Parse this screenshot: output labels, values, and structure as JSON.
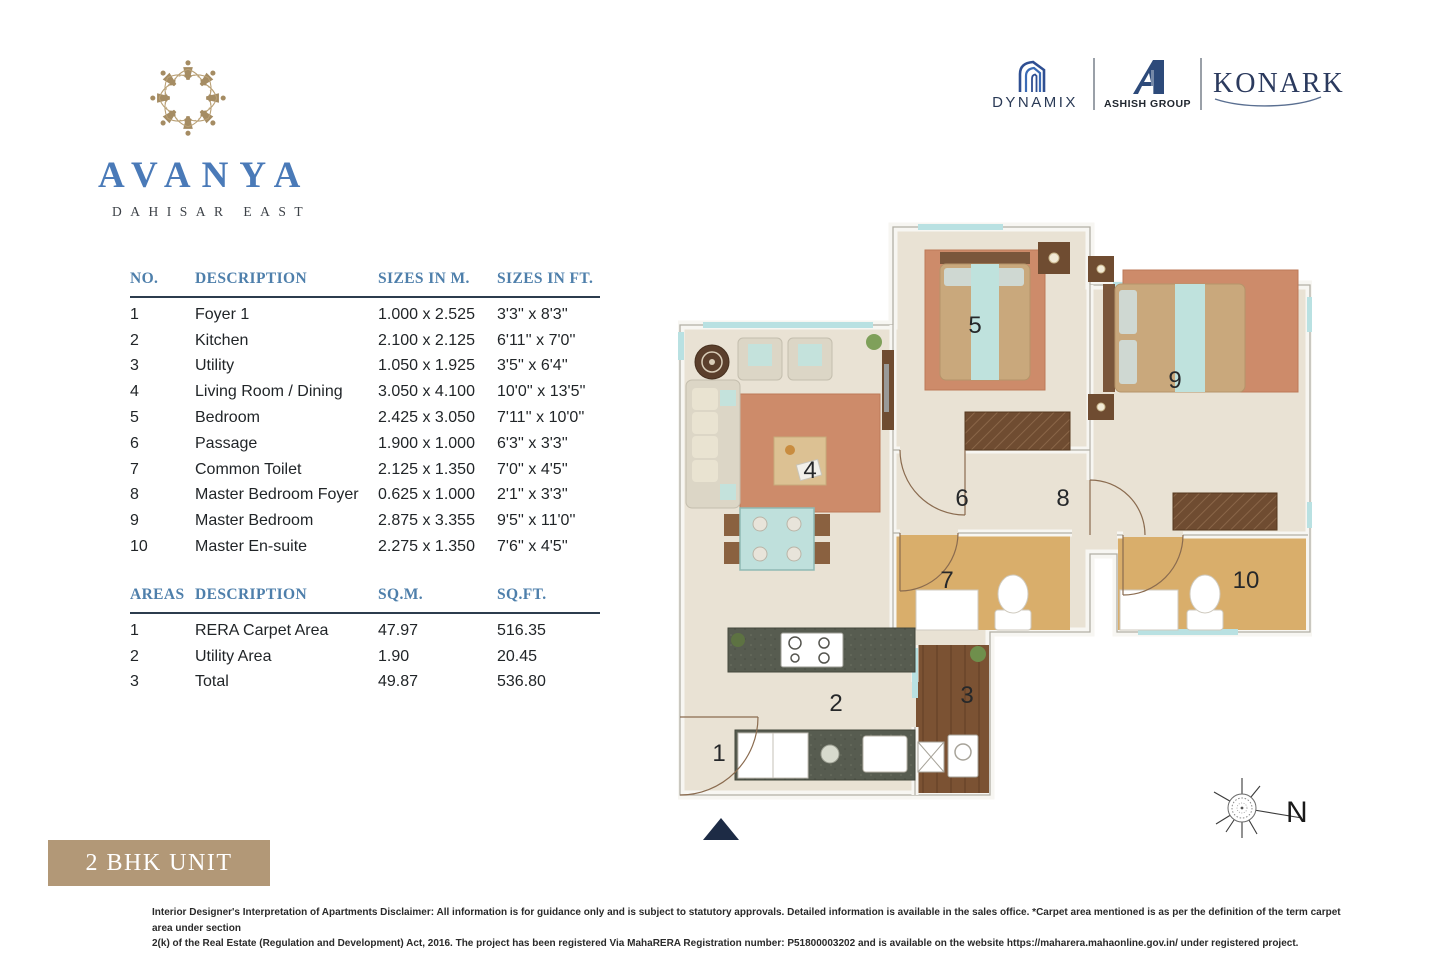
{
  "brand": {
    "name": "AVANYA",
    "location": "DAHISAR EAST"
  },
  "partners": {
    "dynamix": "DYNAMIX",
    "ashish": "ASHISH GROUP",
    "konark": "KONARK"
  },
  "dimensions_table": {
    "headers": [
      "NO.",
      "DESCRIPTION",
      "SIZES IN M.",
      "SIZES IN FT."
    ],
    "rows": [
      [
        "1",
        "Foyer 1",
        "1.000 x 2.525",
        "3'3'' x 8'3''"
      ],
      [
        "2",
        "Kitchen",
        "2.100 x 2.125",
        "6'11'' x 7'0''"
      ],
      [
        "3",
        "Utility",
        "1.050 x 1.925",
        "3'5'' x 6'4''"
      ],
      [
        "4",
        "Living Room / Dining",
        "3.050 x 4.100",
        "10'0'' x 13'5''"
      ],
      [
        "5",
        "Bedroom",
        "2.425 x 3.050",
        "7'11'' x 10'0''"
      ],
      [
        "6",
        "Passage",
        "1.900 x 1.000",
        "6'3'' x 3'3''"
      ],
      [
        "7",
        "Common Toilet",
        "2.125 x 1.350",
        "7'0'' x 4'5''"
      ],
      [
        "8",
        "Master Bedroom Foyer",
        "0.625 x 1.000",
        "2'1'' x 3'3''"
      ],
      [
        "9",
        "Master Bedroom",
        "2.875 x 3.355",
        "9'5'' x 11'0''"
      ],
      [
        "10",
        "Master En-suite",
        "2.275 x 1.350",
        "7'6'' x 4'5''"
      ]
    ]
  },
  "areas_table": {
    "headers": [
      "AREAS",
      "DESCRIPTION",
      "SQ.M.",
      "SQ.FT."
    ],
    "rows": [
      [
        "1",
        "RERA Carpet Area",
        "47.97",
        "516.35"
      ],
      [
        "2",
        "Utility Area",
        "1.90",
        "20.45"
      ],
      [
        "3",
        "Total",
        "49.87",
        "536.80"
      ]
    ]
  },
  "floorplan": {
    "rooms": [
      {
        "number": "1"
      },
      {
        "number": "2"
      },
      {
        "number": "3"
      },
      {
        "number": "4"
      },
      {
        "number": "5"
      },
      {
        "number": "6"
      },
      {
        "number": "7"
      },
      {
        "number": "8"
      },
      {
        "number": "9"
      },
      {
        "number": "10"
      }
    ]
  },
  "unit_label": "2 BHK UNIT",
  "compass_label": "N",
  "disclaimer": {
    "bold": "Interior Designer's Interpretation of Apartments Disclaimer:",
    "line1": "All information is for guidance only and is subject to statutory approvals. Detailed information is available in the sales office. *Carpet area mentioned is as per the definition of the term carpet area under section",
    "line2": "2(k) of the Real Estate (Regulation and Development) Act, 2016. The project has been registered Via MahaRERA Registration number: P51800003202 and is available on the website https://maharera.mahaonline.gov.in/ under registered project."
  },
  "colors": {
    "brand_blue": "#4a7ab8",
    "header_blue": "#4e7fab",
    "tan_box": "#b29877",
    "logo_gold": "#a58c63",
    "navy": "#1d2b45",
    "floor_beige": "#e9e2d4",
    "rug_terracotta": "#cd8b6a",
    "accent_teal": "#bfe2dd",
    "toilet_tan": "#d9ae6b",
    "wood_brown": "#7b5233"
  }
}
